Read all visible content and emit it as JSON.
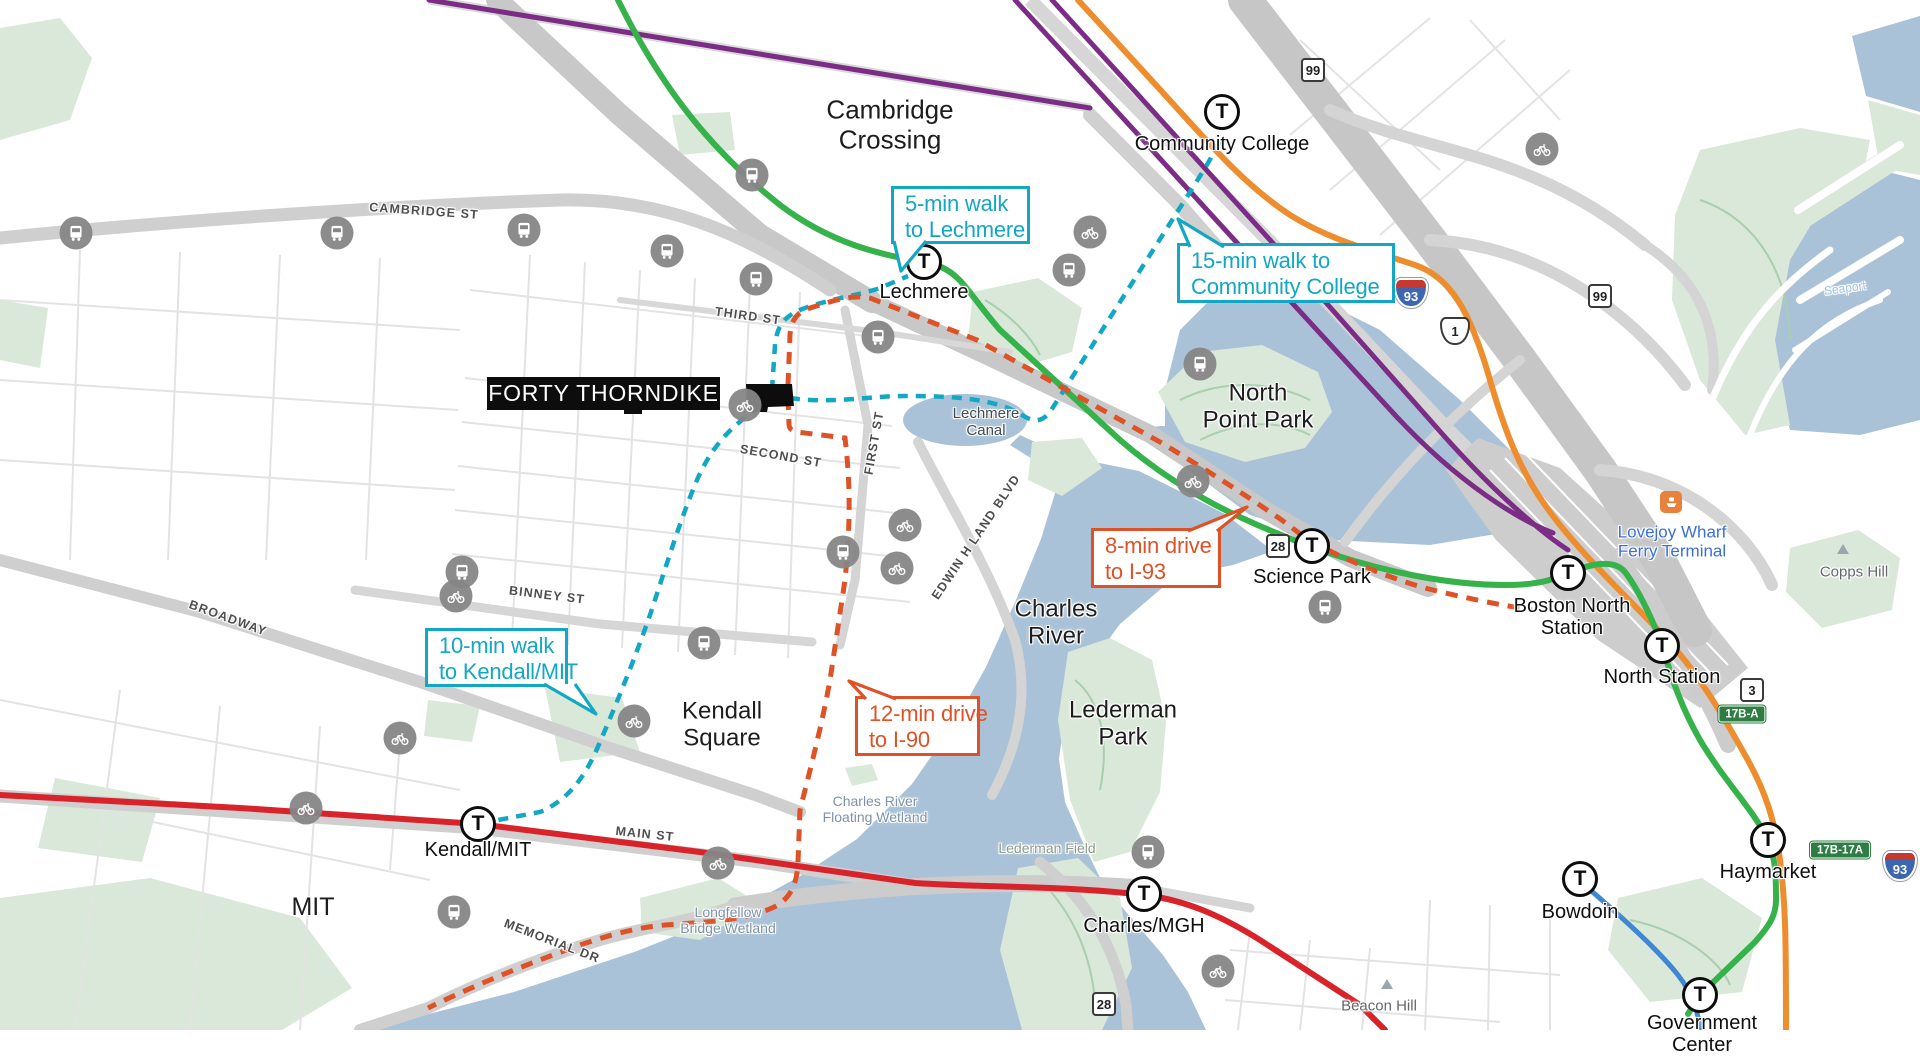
{
  "colors": {
    "walk_teal": "#12a7c4",
    "drive_orange": "#dd5226",
    "green_line": "#35b24a",
    "red_line": "#d9232a",
    "orange_line": "#ee8d2e",
    "purple_line": "#7b2d86",
    "blue_line": "#3f87d2",
    "water": "#a9c2d8",
    "park": "#d9e8d8",
    "road_gray": "#c9c9c9"
  },
  "t_logo": "T",
  "property": {
    "label": "FORTY THORNDIKE"
  },
  "callouts": [
    {
      "id": "lechmere-walk",
      "lines": [
        "5-min walk",
        "to Lechmere"
      ],
      "style": "walk",
      "x": 891,
      "y": 186,
      "w": 139,
      "h": 58
    },
    {
      "id": "community-college-walk",
      "lines": [
        "15-min walk to",
        "Community College"
      ],
      "style": "walk",
      "x": 1177,
      "y": 243,
      "w": 218,
      "h": 60
    },
    {
      "id": "kendall-walk",
      "lines": [
        "10-min walk",
        "to Kendall/MIT"
      ],
      "style": "walk",
      "x": 425,
      "y": 628,
      "w": 143,
      "h": 59
    },
    {
      "id": "i93-drive",
      "lines": [
        "8-min drive",
        "to I-93"
      ],
      "style": "drive",
      "x": 1091,
      "y": 528,
      "w": 130,
      "h": 60
    },
    {
      "id": "i90-drive",
      "lines": [
        "12-min drive",
        "to I-90"
      ],
      "style": "drive",
      "x": 855,
      "y": 696,
      "w": 125,
      "h": 60
    }
  ],
  "stations": [
    {
      "id": "community-college",
      "lines": [
        "Community College"
      ],
      "x": 1222,
      "y": 112,
      "lx": 1222,
      "ly": 133
    },
    {
      "id": "lechmere",
      "lines": [
        "Lechmere"
      ],
      "x": 924,
      "y": 262,
      "lx": 924,
      "ly": 281
    },
    {
      "id": "science-park",
      "lines": [
        "Science Park"
      ],
      "x": 1312,
      "y": 546,
      "lx": 1312,
      "ly": 566
    },
    {
      "id": "boston-north-station",
      "lines": [
        "Boston North",
        "Station"
      ],
      "x": 1568,
      "y": 573,
      "lx": 1572,
      "ly": 595
    },
    {
      "id": "north-station",
      "lines": [
        "North Station"
      ],
      "x": 1662,
      "y": 646,
      "lx": 1662,
      "ly": 666
    },
    {
      "id": "haymarket",
      "lines": [
        "Haymarket"
      ],
      "x": 1768,
      "y": 840,
      "lx": 1768,
      "ly": 861
    },
    {
      "id": "bowdoin",
      "lines": [
        "Bowdoin"
      ],
      "x": 1580,
      "y": 879,
      "lx": 1580,
      "ly": 901
    },
    {
      "id": "government-center",
      "lines": [
        "Government",
        "Center"
      ],
      "x": 1700,
      "y": 995,
      "lx": 1702,
      "ly": 1012
    },
    {
      "id": "charles-mgh",
      "lines": [
        "Charles/MGH"
      ],
      "x": 1144,
      "y": 894,
      "lx": 1144,
      "ly": 915
    },
    {
      "id": "kendall-mit",
      "lines": [
        "Kendall/MIT"
      ],
      "x": 478,
      "y": 824,
      "lx": 478,
      "ly": 839
    }
  ],
  "area_labels": [
    {
      "id": "cambridge-crossing",
      "lines": [
        "Cambridge",
        "Crossing"
      ],
      "x": 890,
      "y": 125,
      "size": 26,
      "cls": ""
    },
    {
      "id": "north-point-park",
      "lines": [
        "North",
        "Point Park"
      ],
      "x": 1258,
      "y": 407,
      "size": 24,
      "cls": ""
    },
    {
      "id": "charles-river",
      "lines": [
        "Charles",
        "River"
      ],
      "x": 1056,
      "y": 623,
      "size": 24,
      "cls": ""
    },
    {
      "id": "lederman-park",
      "lines": [
        "Lederman",
        "Park"
      ],
      "x": 1123,
      "y": 724,
      "size": 24,
      "cls": ""
    },
    {
      "id": "kendall-square",
      "lines": [
        "Kendall",
        "Square"
      ],
      "x": 722,
      "y": 725,
      "size": 24,
      "cls": ""
    },
    {
      "id": "mit",
      "lines": [
        "MIT"
      ],
      "x": 313,
      "y": 907,
      "size": 25,
      "cls": ""
    },
    {
      "id": "lechmere-canal",
      "lines": [
        "Lechmere",
        "Canal"
      ],
      "x": 986,
      "y": 422,
      "size": 15,
      "cls": "c-slate"
    },
    {
      "id": "lovejoy-wharf",
      "lines": [
        "Lovejoy Wharf",
        "Ferry Terminal"
      ],
      "x": 1672,
      "y": 542,
      "size": 17,
      "cls": "c-blue"
    },
    {
      "id": "copps-hill",
      "lines": [
        "Copps Hill"
      ],
      "x": 1854,
      "y": 572,
      "size": 15,
      "cls": "c-hill"
    },
    {
      "id": "beacon-hill",
      "lines": [
        "Beacon Hill"
      ],
      "x": 1379,
      "y": 1006,
      "size": 15,
      "cls": "c-hill"
    },
    {
      "id": "longfellow-bridge-wetland",
      "lines": [
        "Longfellow",
        "Bridge Wetland"
      ],
      "x": 728,
      "y": 921,
      "size": 14,
      "cls": "c-wet"
    },
    {
      "id": "charles-river-floating-wetland",
      "lines": [
        "Charles River",
        "Floating Wetland"
      ],
      "x": 875,
      "y": 810,
      "size": 14,
      "cls": "c-wet"
    },
    {
      "id": "lederman-field",
      "lines": [
        "Lederman Field"
      ],
      "x": 1047,
      "y": 849,
      "size": 14,
      "cls": "c-field"
    },
    {
      "id": "seaport",
      "lines": [
        "Seaport"
      ],
      "x": 1845,
      "y": 289,
      "size": 12,
      "cls": "c-seaport",
      "rot": -8
    }
  ],
  "street_labels": [
    {
      "id": "cambridge-st",
      "text": "CAMBRIDGE ST",
      "x": 424,
      "y": 211,
      "r": 4
    },
    {
      "id": "third-st",
      "text": "THIRD ST",
      "x": 748,
      "y": 316,
      "r": 8
    },
    {
      "id": "second-st",
      "text": "SECOND ST",
      "x": 781,
      "y": 456,
      "r": 10
    },
    {
      "id": "first-st",
      "text": "FIRST ST",
      "x": 874,
      "y": 443,
      "r": -80
    },
    {
      "id": "binney-st",
      "text": "BINNEY ST",
      "x": 547,
      "y": 595,
      "r": 7
    },
    {
      "id": "broadway",
      "text": "BROADWAY",
      "x": 228,
      "y": 618,
      "r": 20
    },
    {
      "id": "main-st",
      "text": "MAIN ST",
      "x": 645,
      "y": 834,
      "r": 6
    },
    {
      "id": "memorial-dr",
      "text": "MEMORIAL DR",
      "x": 552,
      "y": 941,
      "r": 21
    },
    {
      "id": "edwin-h-land-blvd",
      "text": "EDWIN H LAND BLVD",
      "x": 976,
      "y": 537,
      "r": -56
    }
  ],
  "shields": [
    {
      "type": "int",
      "text": "93",
      "x": 1411,
      "y": 293
    },
    {
      "type": "int",
      "text": "93",
      "x": 1900,
      "y": 866
    },
    {
      "type": "us",
      "text": "1",
      "x": 1455,
      "y": 331
    },
    {
      "type": "sq",
      "text": "99",
      "x": 1313,
      "y": 70
    },
    {
      "type": "sq",
      "text": "99",
      "x": 1600,
      "y": 296
    },
    {
      "type": "sq",
      "text": "28",
      "x": 1278,
      "y": 546
    },
    {
      "type": "sq",
      "text": "28",
      "x": 1104,
      "y": 1004
    },
    {
      "type": "sq",
      "text": "3",
      "x": 1752,
      "y": 690
    },
    {
      "type": "exit",
      "text": "17B-A",
      "x": 1742,
      "y": 714
    },
    {
      "type": "exit",
      "text": "17B-17A",
      "x": 1840,
      "y": 850
    }
  ],
  "icons": [
    {
      "type": "bus",
      "x": 76,
      "y": 233
    },
    {
      "type": "bus",
      "x": 337,
      "y": 233
    },
    {
      "type": "bus",
      "x": 524,
      "y": 230
    },
    {
      "type": "bus",
      "x": 667,
      "y": 251
    },
    {
      "type": "bus",
      "x": 752,
      "y": 175
    },
    {
      "type": "bus",
      "x": 756,
      "y": 279
    },
    {
      "type": "bus",
      "x": 878,
      "y": 337
    },
    {
      "type": "bus",
      "x": 1069,
      "y": 270
    },
    {
      "type": "bus",
      "x": 1200,
      "y": 364
    },
    {
      "type": "bus",
      "x": 843,
      "y": 552
    },
    {
      "type": "bus",
      "x": 1325,
      "y": 607
    },
    {
      "type": "bus",
      "x": 462,
      "y": 572
    },
    {
      "type": "bus",
      "x": 704,
      "y": 643
    },
    {
      "type": "bus",
      "x": 454,
      "y": 912
    },
    {
      "type": "bus",
      "x": 1148,
      "y": 852
    },
    {
      "type": "bike",
      "x": 745,
      "y": 405
    },
    {
      "type": "bike",
      "x": 905,
      "y": 525
    },
    {
      "type": "bike",
      "x": 897,
      "y": 568
    },
    {
      "type": "bike",
      "x": 1090,
      "y": 232
    },
    {
      "type": "bike",
      "x": 400,
      "y": 738
    },
    {
      "type": "bike",
      "x": 634,
      "y": 721
    },
    {
      "type": "bike",
      "x": 306,
      "y": 808
    },
    {
      "type": "bike",
      "x": 718,
      "y": 863
    },
    {
      "type": "bike",
      "x": 1193,
      "y": 481
    },
    {
      "type": "bike",
      "x": 1542,
      "y": 149
    },
    {
      "type": "bike",
      "x": 456,
      "y": 596
    },
    {
      "type": "bike",
      "x": 1218,
      "y": 971
    },
    {
      "type": "ferry",
      "x": 1671,
      "y": 502
    },
    {
      "type": "peak",
      "x": 1843,
      "y": 549
    },
    {
      "type": "peak",
      "x": 1387,
      "y": 984
    }
  ]
}
